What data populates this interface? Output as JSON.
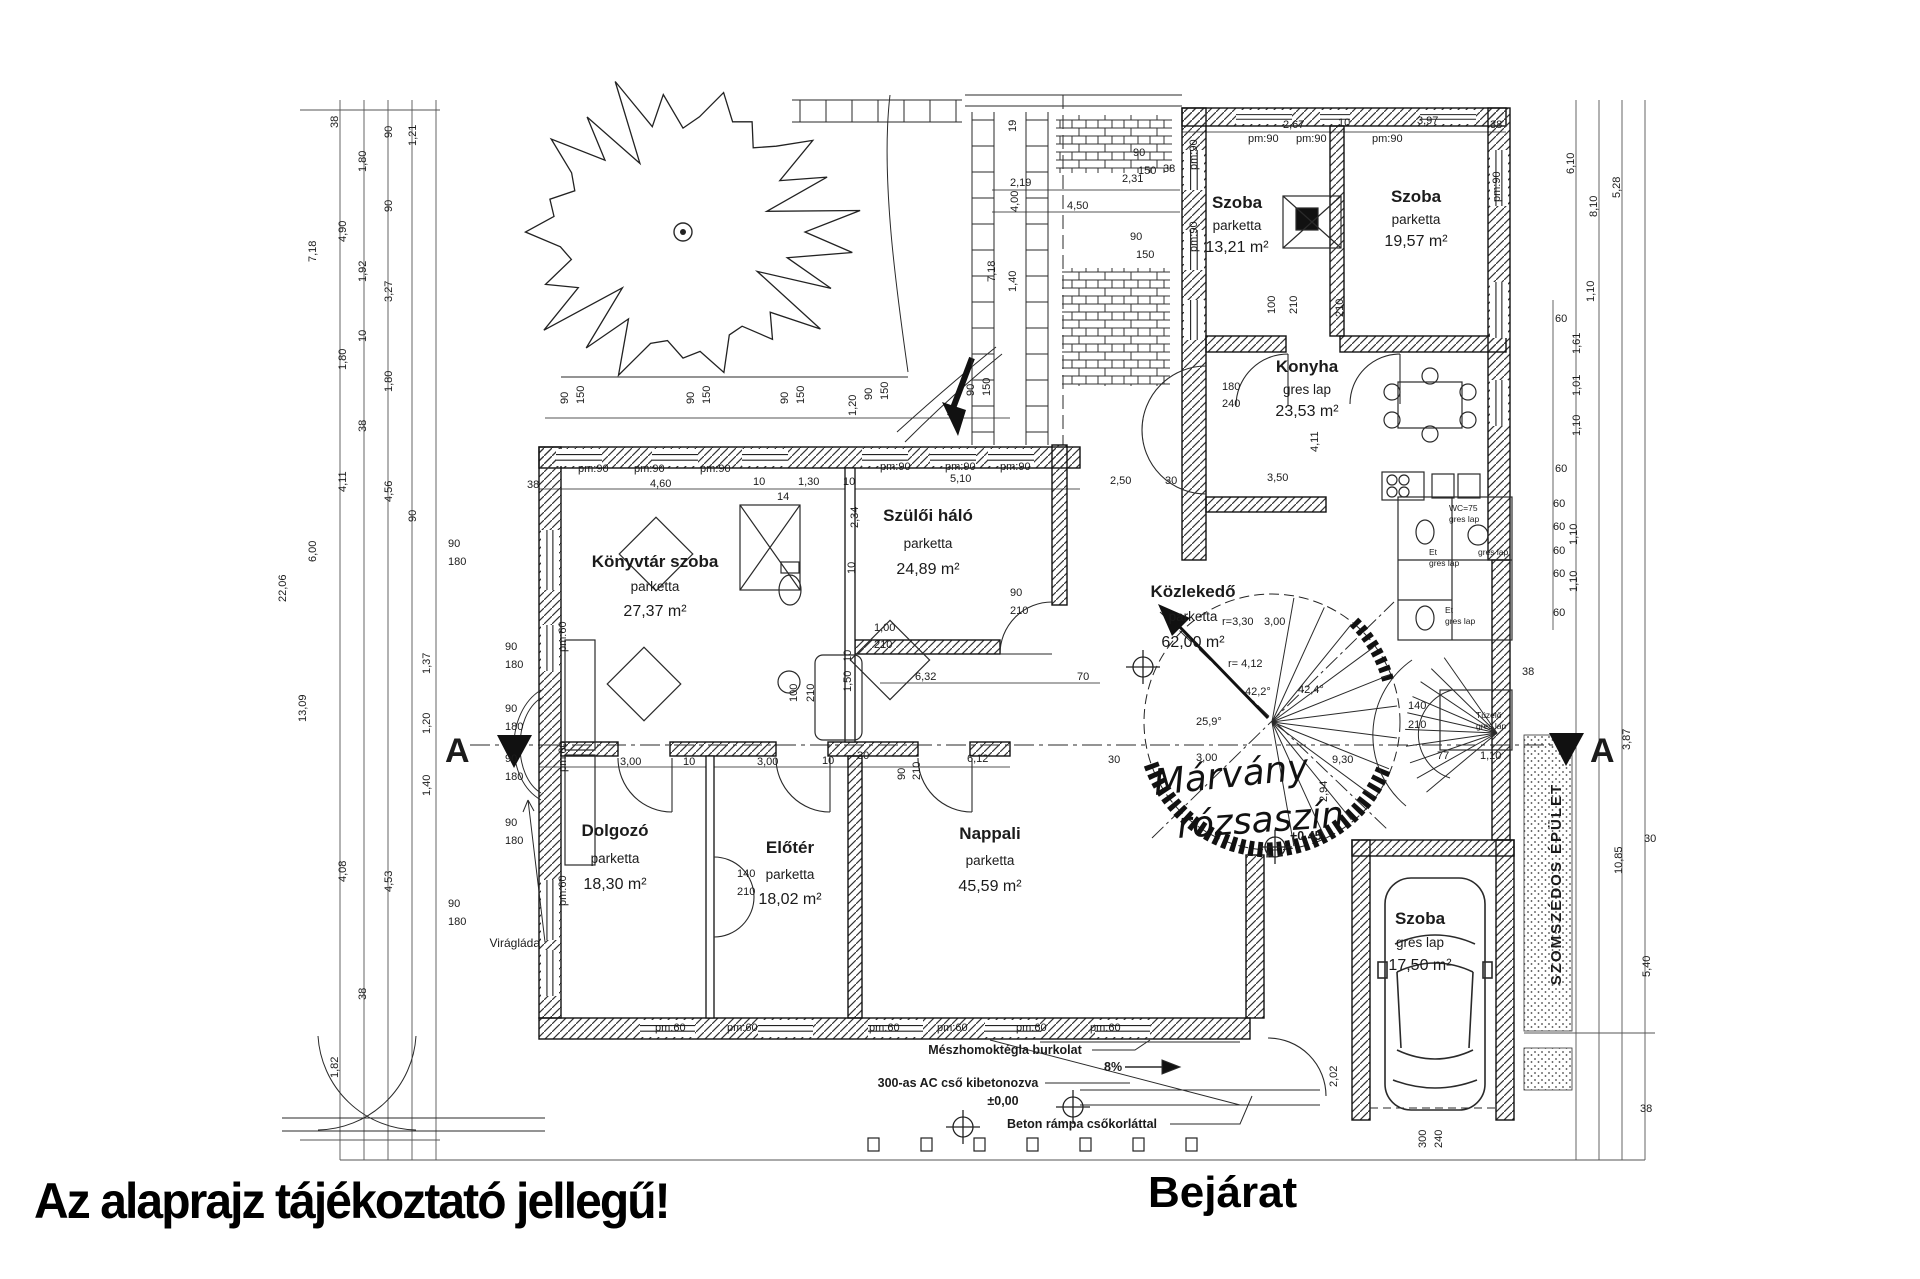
{
  "notice": {
    "text": "Az alaprajz tájékoztató jellegű!"
  },
  "entrance": {
    "label": "Bejárat"
  },
  "section_marker": {
    "letter": "A"
  },
  "neighbor_label": "SZOMSZÉDOS ÉPÜLET",
  "handwritten_note": {
    "line1": "Márvány",
    "line2": "rózsaszín"
  },
  "rooms": [
    {
      "name": "Szoba",
      "floor": "parketta",
      "area": "13,21 m²"
    },
    {
      "name": "Szoba",
      "floor": "parketta",
      "area": "19,57 m²"
    },
    {
      "name": "Konyha",
      "floor": "gres lap",
      "area": "23,53 m²"
    },
    {
      "name": "Szülői háló",
      "floor": "parketta",
      "area": "24,89 m²"
    },
    {
      "name": "Könyvtár szoba",
      "floor": "parketta",
      "area": "27,37 m²"
    },
    {
      "name": "Közlekedő",
      "floor": "parketta",
      "area": "62,00 m²"
    },
    {
      "name": "Dolgozó",
      "floor": "parketta",
      "area": "18,30 m²"
    },
    {
      "name": "Előtér",
      "floor": "parketta",
      "area": "18,02 m²"
    },
    {
      "name": "Nappali",
      "floor": "parketta",
      "area": "45,59 m²"
    },
    {
      "name": "Szoba",
      "floor": "gres lap",
      "area": "17,50 m²"
    }
  ],
  "annotations": {
    "viraglada": "Virágláda",
    "burkolat": "Mészhomoktégla burkolat",
    "ac_cso": "300-as AC cső kibetonozva",
    "zero_level": "±0,00",
    "ramp": "Beton rámpa csőkorláttal",
    "slope": "8%",
    "level_045": "+0,45"
  },
  "tiny_labels": [
    [
      "WC=75",
      1449,
      511
    ],
    [
      "gres lap",
      1449,
      522
    ],
    [
      "Et",
      1429,
      555
    ],
    [
      "gres lap",
      1429,
      566
    ],
    [
      "gres lap",
      1478,
      555
    ],
    [
      "Et",
      1445,
      613
    ],
    [
      "gres lap",
      1445,
      624
    ],
    [
      "Tüzelő",
      1476,
      718
    ],
    [
      "gres lap",
      1476,
      729
    ]
  ],
  "dim_labels": [
    [
      "38",
      338,
      128,
      -90
    ],
    [
      "90",
      392,
      138,
      -90
    ],
    [
      "1,21",
      416,
      146,
      -90
    ],
    [
      "1,80",
      366,
      172,
      -90
    ],
    [
      "4,90",
      346,
      242,
      -90
    ],
    [
      "90",
      392,
      212,
      -90
    ],
    [
      "1,92",
      366,
      282,
      -90
    ],
    [
      "3,27",
      392,
      302,
      -90
    ],
    [
      "7,18",
      316,
      262,
      -90
    ],
    [
      "10",
      366,
      342,
      -90
    ],
    [
      "1,80",
      346,
      370,
      -90
    ],
    [
      "1,80",
      392,
      392,
      -90
    ],
    [
      "38",
      366,
      432,
      -90
    ],
    [
      "4,11",
      346,
      492,
      -90
    ],
    [
      "4,56",
      392,
      502,
      -90
    ],
    [
      "6,00",
      316,
      562,
      -90
    ],
    [
      "22,06",
      286,
      602,
      -90
    ],
    [
      "90",
      416,
      522,
      -90
    ],
    [
      "13,09",
      306,
      722,
      -90
    ],
    [
      "1,37",
      430,
      674,
      -90
    ],
    [
      "1,20",
      430,
      734,
      -90
    ],
    [
      "1,40",
      430,
      796,
      -90
    ],
    [
      "4,08",
      346,
      882,
      -90
    ],
    [
      "4,53",
      392,
      892,
      -90
    ],
    [
      "1,82",
      338,
      1078,
      -90
    ],
    [
      "38",
      366,
      1000,
      -90
    ],
    [
      "90",
      448,
      547
    ],
    [
      "180",
      448,
      565
    ],
    [
      "90",
      505,
      650
    ],
    [
      "180",
      505,
      668
    ],
    [
      "90",
      505,
      712
    ],
    [
      "180",
      505,
      730
    ],
    [
      "90",
      505,
      762
    ],
    [
      "180",
      505,
      780
    ],
    [
      "90",
      505,
      826
    ],
    [
      "180",
      505,
      844
    ],
    [
      "90",
      448,
      907
    ],
    [
      "180",
      448,
      925
    ],
    [
      "pm:60",
      566,
      652,
      -90
    ],
    [
      "pm:60",
      566,
      772,
      -90
    ],
    [
      "pm:60",
      566,
      906,
      -90
    ],
    [
      "90",
      568,
      404,
      -90
    ],
    [
      "150",
      584,
      404,
      -90
    ],
    [
      "90",
      694,
      404,
      -90
    ],
    [
      "150",
      710,
      404,
      -90
    ],
    [
      "90",
      788,
      404,
      -90
    ],
    [
      "150",
      804,
      404,
      -90
    ],
    [
      "1,20",
      856,
      416,
      -90
    ],
    [
      "90",
      872,
      400,
      -90
    ],
    [
      "150",
      888,
      400,
      -90
    ],
    [
      "90",
      974,
      396,
      -90
    ],
    [
      "150",
      990,
      396,
      -90
    ],
    [
      "19",
      1016,
      132,
      -90
    ],
    [
      "90",
      1133,
      156
    ],
    [
      "150",
      1138,
      174
    ],
    [
      "38",
      1163,
      172
    ],
    [
      "2,19",
      1010,
      186
    ],
    [
      "2,31",
      1122,
      182
    ],
    [
      "4,50",
      1067,
      209
    ],
    [
      "4,00",
      1018,
      212,
      -90
    ],
    [
      "90",
      1130,
      240
    ],
    [
      "150",
      1136,
      258
    ],
    [
      "7,18",
      995,
      282,
      -90
    ],
    [
      "1,40",
      1016,
      292,
      -90
    ],
    [
      "2,67",
      1283,
      128
    ],
    [
      "10",
      1338,
      126
    ],
    [
      "3,97",
      1417,
      124
    ],
    [
      "38",
      1490,
      128
    ],
    [
      "pm:90",
      1248,
      142
    ],
    [
      "pm:90",
      1296,
      142
    ],
    [
      "pm:90",
      1372,
      142
    ],
    [
      "pm:90",
      1197,
      170,
      -90
    ],
    [
      "pm:90",
      1197,
      252,
      -90
    ],
    [
      "pm:90",
      1500,
      202,
      -90
    ],
    [
      "100",
      1275,
      314,
      -90
    ],
    [
      "210",
      1297,
      314,
      -90
    ],
    [
      "210",
      1343,
      317,
      -90
    ],
    [
      "180",
      1222,
      390
    ],
    [
      "240",
      1222,
      407
    ],
    [
      "3,50",
      1267,
      481
    ],
    [
      "4,11",
      1318,
      452,
      -90
    ],
    [
      "pm:90",
      578,
      472
    ],
    [
      "pm:90",
      634,
      472
    ],
    [
      "pm:90",
      700,
      472
    ],
    [
      "4,60",
      650,
      487
    ],
    [
      "38",
      527,
      488
    ],
    [
      "10",
      753,
      485
    ],
    [
      "1,30",
      798,
      485
    ],
    [
      "10",
      843,
      485
    ],
    [
      "14",
      777,
      500
    ],
    [
      "pm:90",
      880,
      470
    ],
    [
      "pm:90",
      945,
      470
    ],
    [
      "pm:90",
      1000,
      470
    ],
    [
      "5,10",
      950,
      482
    ],
    [
      "2,50",
      1110,
      484
    ],
    [
      "30",
      1165,
      484
    ],
    [
      "2,34",
      858,
      528,
      -90
    ],
    [
      "10",
      855,
      574,
      -90
    ],
    [
      "1,00",
      874,
      631
    ],
    [
      "210",
      874,
      648
    ],
    [
      "90",
      1010,
      596
    ],
    [
      "210",
      1010,
      614
    ],
    [
      "100",
      797,
      702,
      -90
    ],
    [
      "210",
      814,
      702,
      -90
    ],
    [
      "10",
      851,
      662,
      -90
    ],
    [
      "1,50",
      851,
      692,
      -90
    ],
    [
      "6,32",
      915,
      680
    ],
    [
      "70",
      1077,
      680
    ],
    [
      "90",
      905,
      780,
      -90
    ],
    [
      "210",
      920,
      780,
      -90
    ],
    [
      "3,00",
      620,
      765
    ],
    [
      "10",
      683,
      765
    ],
    [
      "3,00",
      757,
      765
    ],
    [
      "10",
      822,
      764
    ],
    [
      "30",
      857,
      759
    ],
    [
      "6,12",
      967,
      762
    ],
    [
      "140",
      737,
      877
    ],
    [
      "210",
      737,
      895
    ],
    [
      "25,9°",
      1196,
      725
    ],
    [
      "42,2°",
      1245,
      695
    ],
    [
      "42,4°",
      1298,
      693
    ],
    [
      "r=3,30",
      1222,
      625
    ],
    [
      "3,00",
      1264,
      625
    ],
    [
      "r= 4,12",
      1228,
      667
    ],
    [
      "9,30",
      1332,
      763
    ],
    [
      "3,00",
      1196,
      761
    ],
    [
      "30",
      1108,
      763
    ],
    [
      "2,94",
      1327,
      802,
      -90
    ],
    [
      "77",
      1437,
      759
    ],
    [
      "1,10",
      1480,
      759
    ],
    [
      "140",
      1408,
      709
    ],
    [
      "210",
      1408,
      728
    ],
    [
      "38",
      1522,
      675
    ],
    [
      "6,10",
      1574,
      174,
      -90
    ],
    [
      "8,10",
      1597,
      217,
      -90
    ],
    [
      "5,28",
      1620,
      198,
      -90
    ],
    [
      "1,10",
      1594,
      302,
      -90
    ],
    [
      "1,61",
      1580,
      354,
      -90
    ],
    [
      "1,01",
      1580,
      396,
      -90
    ],
    [
      "1,10",
      1580,
      436,
      -90
    ],
    [
      "60",
      1555,
      322
    ],
    [
      "60",
      1555,
      472
    ],
    [
      "60",
      1553,
      507
    ],
    [
      "60",
      1553,
      530
    ],
    [
      "60",
      1553,
      554
    ],
    [
      "60",
      1553,
      577
    ],
    [
      "60",
      1553,
      616
    ],
    [
      "1,10",
      1577,
      545,
      -90
    ],
    [
      "1,10",
      1577,
      592,
      -90
    ],
    [
      "3,87",
      1630,
      750,
      -90
    ],
    [
      "30",
      1644,
      842
    ],
    [
      "10,85",
      1622,
      874,
      -90
    ],
    [
      "5,40",
      1650,
      977,
      -90
    ],
    [
      "38",
      1640,
      1112
    ],
    [
      "300",
      1426,
      1148,
      -90
    ],
    [
      "240",
      1442,
      1148,
      -90
    ],
    [
      "2,02",
      1337,
      1087,
      -90
    ],
    [
      "pm:60",
      655,
      1031
    ],
    [
      "pm:60",
      727,
      1031
    ],
    [
      "pm:60",
      869,
      1031
    ],
    [
      "pm:60",
      937,
      1031
    ],
    [
      "pm:60",
      1016,
      1031
    ],
    [
      "pm:60",
      1090,
      1031
    ]
  ]
}
